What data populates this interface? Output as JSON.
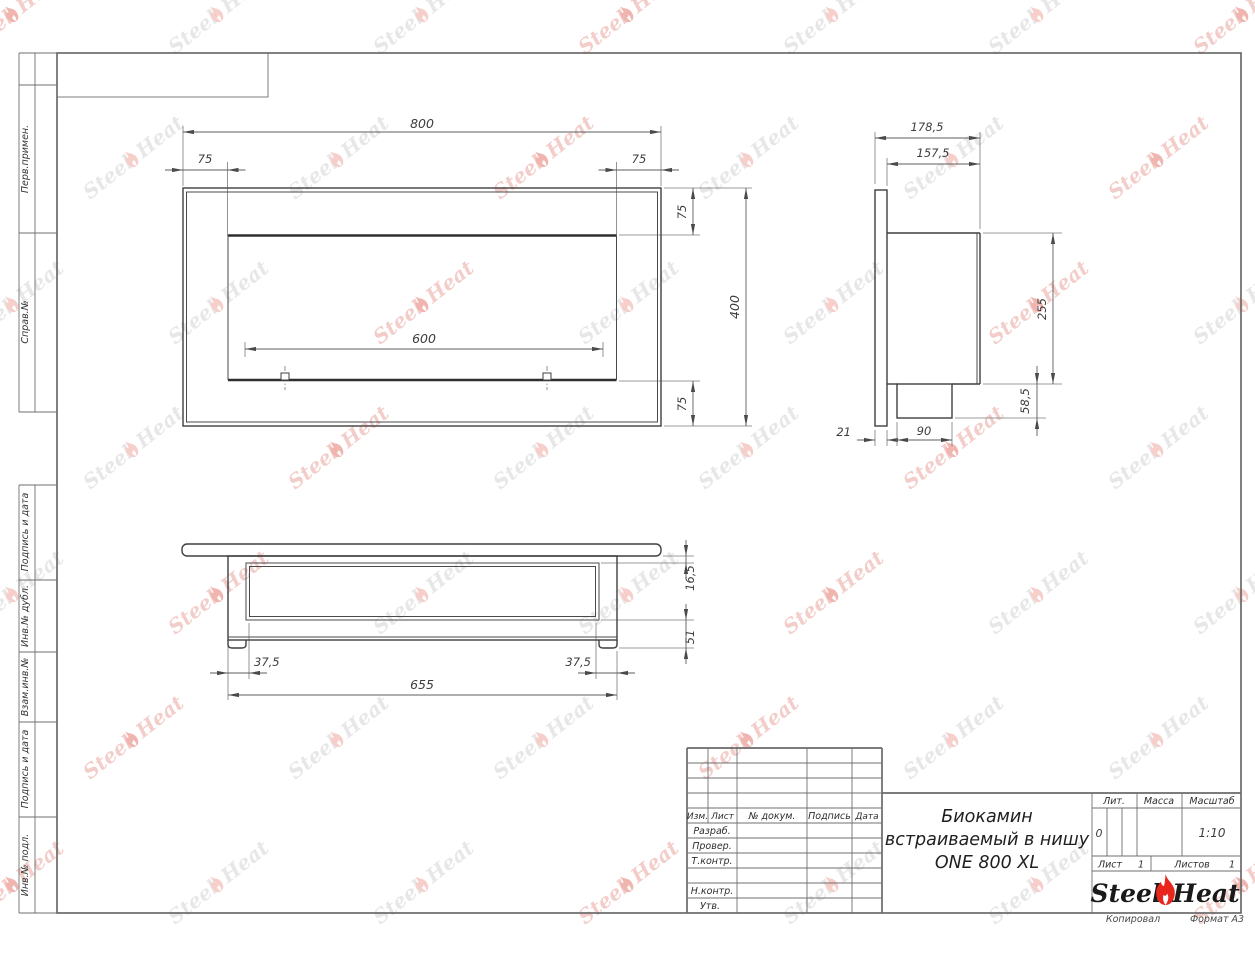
{
  "sheet": {
    "copied_note": "Копировал",
    "format_note": "Формат А3"
  },
  "margin_labels": {
    "perv": "Перв.примен.",
    "sprav": "Справ.№",
    "podpis1": "Подпись и дата",
    "inv_dubl": "Инв.№ дубл.",
    "vzam": "Взам.инв.№",
    "podpis2": "Подпись и дата",
    "inv_podl": "Инв.№ подл."
  },
  "title_block": {
    "col_izm": "Изм.",
    "col_list": "Лист",
    "col_doc": "№ докум.",
    "col_sign": "Подпись",
    "col_date": "Дата",
    "row_razrab": "Разраб.",
    "row_prover": "Провер.",
    "row_tkontr": "Т.контр.",
    "row_nkontr": "Н.контр.",
    "row_utv": "Утв.",
    "title_line1": "Биокамин",
    "title_line2": "встраиваемый в нишу",
    "title_line3": "ONE 800 XL",
    "lit_label": "Лит.",
    "lit_value": "0",
    "mass_label": "Масса",
    "scale_label": "Масштаб",
    "scale_value": "1:10",
    "sheet_label": "Лист",
    "sheet_value": "1",
    "sheets_label": "Листов",
    "sheets_value": "1",
    "logo_steel": "Steel",
    "logo_heat": "Heat"
  },
  "dimensions": {
    "front": {
      "width": "800",
      "flange_left": "75",
      "flange_right": "75",
      "opening": "600",
      "flange_top": "75",
      "flange_bottom": "75",
      "height": "400"
    },
    "side": {
      "depth_total": "178,5",
      "depth_body": "157,5",
      "body_height": "255",
      "bottom_height": "58,5",
      "flange_thickness": "21",
      "bottom_depth": "90"
    },
    "bottom": {
      "top_inset": "16,5",
      "body_depth": "51",
      "inset_left": "37,5",
      "body_width": "655",
      "inset_right": "37,5"
    }
  },
  "watermark": {
    "steel": "Steel",
    "heat": "Heat"
  }
}
